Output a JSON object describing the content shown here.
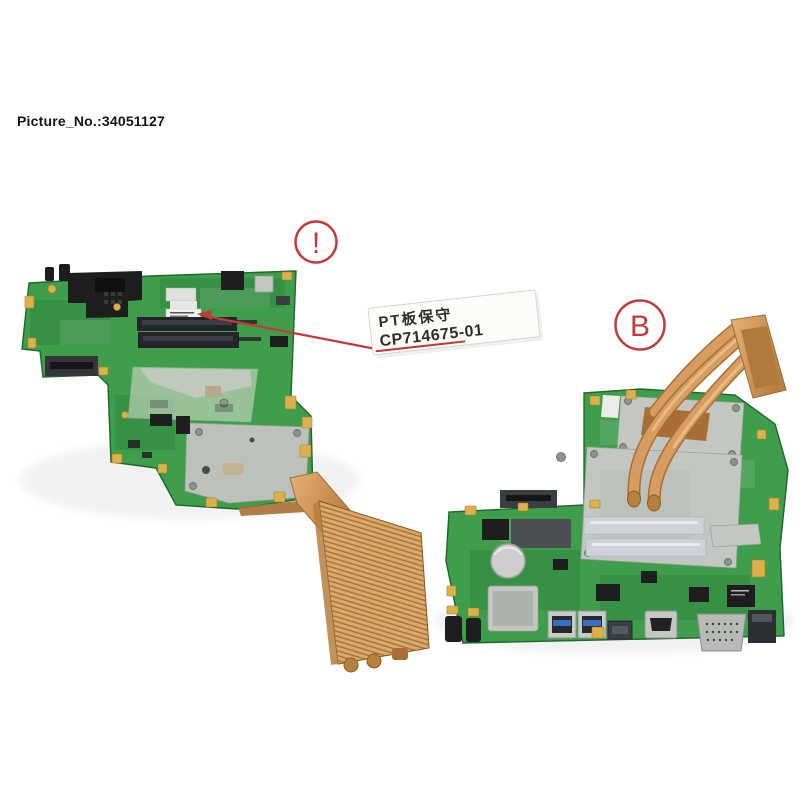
{
  "header": {
    "picture_label": "Picture_No.:34051127"
  },
  "annotations": {
    "caution_mark": "!",
    "variant_mark": "B"
  },
  "service_label": {
    "line1": "PT板保守",
    "line2": "CP714675-01"
  },
  "colors": {
    "background": "#ffffff",
    "text_black": "#151515",
    "accent_red": "#c23a3c",
    "pcb_green": "#3e9e4b",
    "pcb_green_dark": "#20662c",
    "copper": "#d69c60",
    "copper_dark": "#a86f34",
    "metal_gray": "#c3c7c1",
    "gold_pad": "#dcb04b",
    "component_black": "#1e1e1e",
    "label_paper": "#fdfdf8"
  }
}
